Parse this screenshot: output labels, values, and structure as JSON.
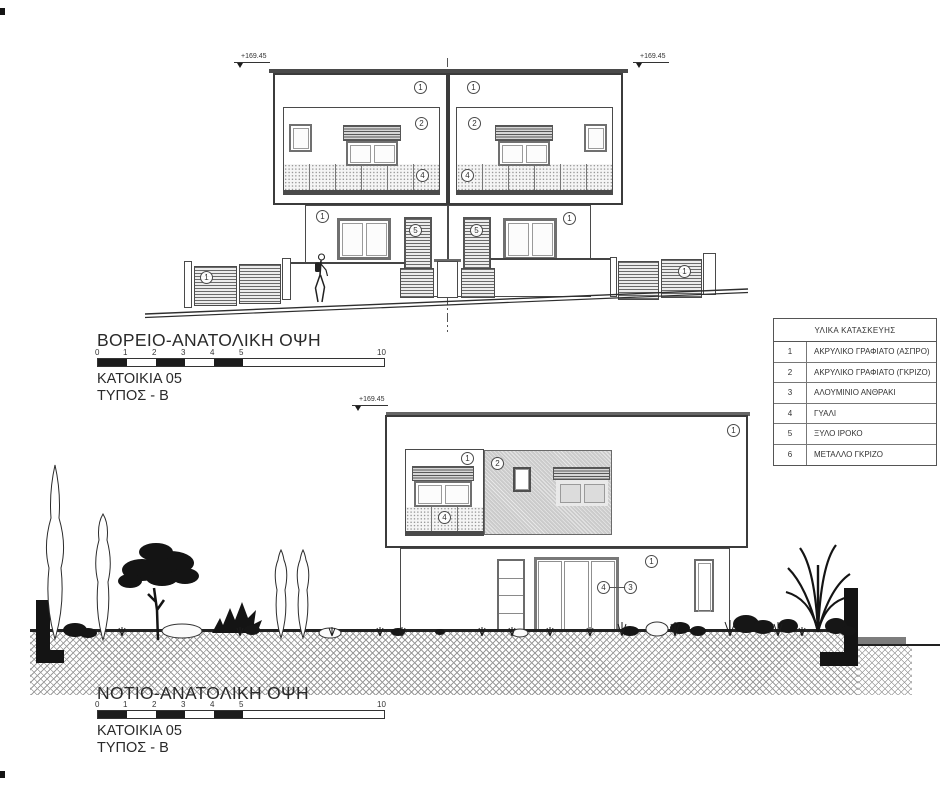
{
  "drawing": {
    "ne_elevation": {
      "title": "ΒΟΡΕΙΟ-ΑΝΑΤΟΛΙΚΗ ΟΨΗ",
      "dwelling": "ΚΑΤΟΙΚΙΑ 05",
      "type_label": "ΤΥΠΟΣ - Β",
      "level_left": "+169.45",
      "level_right": "+169.45"
    },
    "se_elevation": {
      "title": "ΝΟΤΙΟ-ΑΝΑΤΟΛΙΚΗ ΟΨΗ",
      "dwelling": "ΚΑΤΟΙΚΙΑ 05",
      "type_label": "ΤΥΠΟΣ - Β",
      "level_top": "+169.45"
    }
  },
  "scalebar": {
    "labels": [
      "0",
      "1",
      "2",
      "3",
      "4",
      "5"
    ],
    "end_label": "10"
  },
  "callouts": {
    "c1": "1",
    "c2": "2",
    "c3": "3",
    "c4": "4",
    "c5": "5"
  },
  "materials_table": {
    "title": "ΥΛΙΚΑ ΚΑΤΑΣΚΕΥΗΣ",
    "rows": [
      {
        "num": "1",
        "label": "ΑΚΡΥΛΙΚΟ ΓΡΑΦΙΑΤΟ (ΑΣΠΡΟ)"
      },
      {
        "num": "2",
        "label": "ΑΚΡΥΛΙΚΟ ΓΡΑΦΙΑΤΟ (ΓΚΡΙΖΟ)"
      },
      {
        "num": "3",
        "label": "ΑΛΟΥΜΙΝΙΟ ΑΝΘΡΑΚΙ"
      },
      {
        "num": "4",
        "label": "ΓΥΑΛΙ"
      },
      {
        "num": "5",
        "label": "ΞΥΛΟ ΙΡΟΚΟ"
      },
      {
        "num": "6",
        "label": "ΜΕΤΑΛΛΟ ΓΚΡΙΖΟ"
      }
    ]
  },
  "colors": {
    "line": "#3b3b3b",
    "soil_hatch": "#9b9b9b",
    "gray_panel": "#cbcbcb",
    "black_fill": "#141414"
  }
}
